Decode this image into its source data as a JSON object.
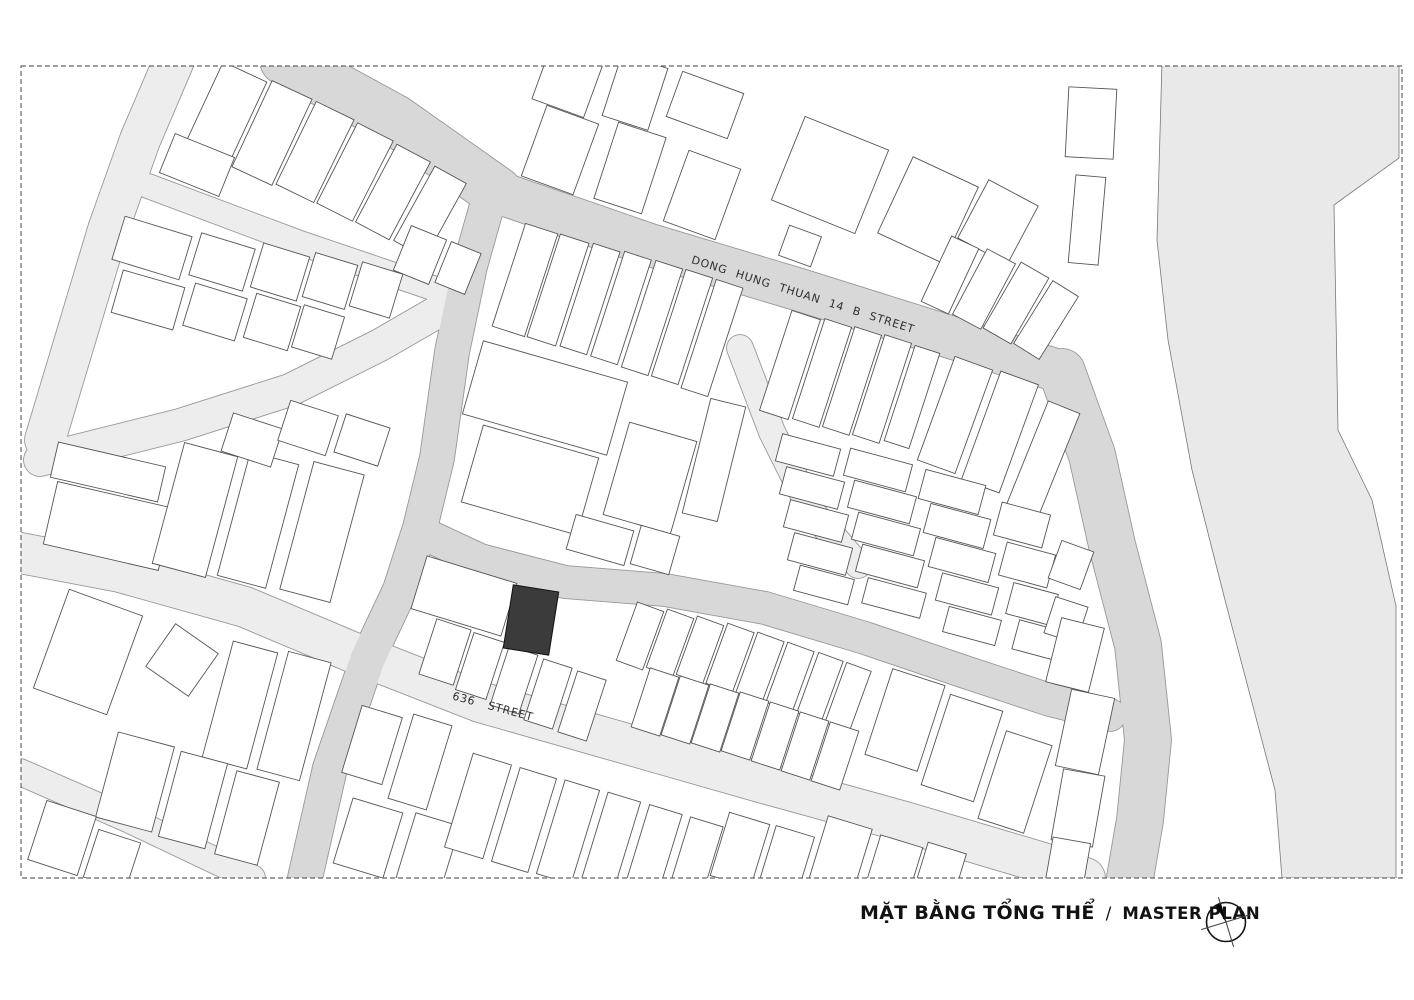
{
  "title": {
    "vi": "MẶT BẰNG TỔNG THỂ",
    "separator": "/",
    "en": "MASTER PLAN"
  },
  "colors": {
    "background": "#ffffff",
    "street_medium": "#d8d8d8",
    "street_light": "#ededed",
    "street_edge": "#989898",
    "river_fill": "#e9e9e9",
    "river_edge": "#787878",
    "building_fill": "#ffffff",
    "building_stroke": "#555555",
    "site_fill": "#3b3b3b",
    "site_stroke": "#111111",
    "border_stroke": "#666666",
    "label_ink": "#2e2e2e"
  },
  "map": {
    "border": {
      "x": 21,
      "y": 66,
      "w": 1381,
      "h": 812
    },
    "river": {
      "points": [
        [
          1162,
          62
        ],
        [
          1157,
          240
        ],
        [
          1168,
          340
        ],
        [
          1192,
          470
        ],
        [
          1225,
          600
        ],
        [
          1275,
          790
        ],
        [
          1282,
          878
        ],
        [
          1396,
          878
        ],
        [
          1396,
          606
        ],
        [
          1372,
          500
        ],
        [
          1338,
          430
        ],
        [
          1334,
          205
        ],
        [
          1399,
          158
        ],
        [
          1399,
          62
        ]
      ]
    },
    "streets": [
      {
        "id": "street-northwest-light",
        "tone": "light",
        "width": 40,
        "points": [
          [
            175,
            58
          ],
          [
            140,
            140
          ],
          [
            108,
            230
          ],
          [
            75,
            340
          ],
          [
            45,
            440
          ]
        ]
      },
      {
        "id": "lane-northwest-upper",
        "tone": "light",
        "width": 24,
        "points": [
          [
            148,
            186
          ],
          [
            300,
            243
          ],
          [
            462,
            298
          ]
        ]
      },
      {
        "id": "lane-northwest-lower",
        "tone": "light",
        "width": 32,
        "points": [
          [
            458,
            300
          ],
          [
            380,
            345
          ],
          [
            290,
            390
          ],
          [
            180,
            425
          ],
          [
            40,
            460
          ]
        ]
      },
      {
        "id": "street-636",
        "tone": "light",
        "width": 40,
        "points": [
          [
            15,
            552
          ],
          [
            120,
            572
          ],
          [
            245,
            607
          ],
          [
            352,
            652
          ],
          [
            480,
            702
          ],
          [
            620,
            742
          ],
          [
            760,
            782
          ],
          [
            905,
            822
          ],
          [
            1040,
            862
          ],
          [
            1085,
            878
          ]
        ]
      },
      {
        "id": "lane-southwest",
        "tone": "light",
        "width": 26,
        "points": [
          [
            20,
            772
          ],
          [
            130,
            820
          ],
          [
            252,
            878
          ]
        ]
      },
      {
        "id": "lane-central-east",
        "tone": "light",
        "width": 26,
        "points": [
          [
            740,
            348
          ],
          [
            772,
            432
          ],
          [
            812,
            512
          ],
          [
            858,
            565
          ]
        ]
      },
      {
        "id": "street-northwest-main",
        "tone": "medium",
        "width": 50,
        "points": [
          [
            285,
            60
          ],
          [
            395,
            120
          ],
          [
            497,
            192
          ]
        ]
      },
      {
        "id": "street-dong-hung-thuan-14b",
        "tone": "medium",
        "width": 42,
        "points": [
          [
            497,
            192
          ],
          [
            650,
            245
          ],
          [
            800,
            290
          ],
          [
            950,
            337
          ],
          [
            1062,
            372
          ]
        ]
      },
      {
        "id": "street-east-vertical",
        "tone": "medium",
        "width": 46,
        "points": [
          [
            1062,
            372
          ],
          [
            1092,
            455
          ],
          [
            1112,
            545
          ],
          [
            1138,
            645
          ],
          [
            1148,
            740
          ],
          [
            1140,
            820
          ],
          [
            1130,
            878
          ]
        ]
      },
      {
        "id": "street-central-vertical",
        "tone": "medium",
        "width": 34,
        "points": [
          [
            492,
            188
          ],
          [
            470,
            266
          ],
          [
            452,
            352
          ],
          [
            437,
            458
          ],
          [
            420,
            528
          ],
          [
            400,
            590
          ],
          [
            368,
            658
          ],
          [
            330,
            768
          ],
          [
            305,
            878
          ]
        ]
      },
      {
        "id": "street-middle-horizontal",
        "tone": "medium",
        "width": 32,
        "points": [
          [
            420,
            532
          ],
          [
            480,
            560
          ],
          [
            565,
            582
          ],
          [
            665,
            590
          ],
          [
            765,
            608
          ],
          [
            865,
            638
          ],
          [
            965,
            672
          ],
          [
            1050,
            700
          ],
          [
            1110,
            715
          ]
        ]
      }
    ],
    "labels": [
      {
        "id": "street-label-dong-hung-thuan-14b",
        "text": "DONG HUNG THUAN 14 B  STREET",
        "x": 802,
        "y": 298,
        "rotate": 17.5,
        "size": 11,
        "word_spacing": 5,
        "letter_spacing": 0.8
      },
      {
        "id": "street-label-636",
        "text": "636  STREET",
        "x": 492,
        "y": 710,
        "rotate": 15,
        "size": 11,
        "word_spacing": 9,
        "letter_spacing": 0.8
      }
    ],
    "site": {
      "cx": 531,
      "cy": 620,
      "w": 46,
      "h": 64,
      "rot": 9
    },
    "buildings": [
      [
        225,
        115,
        48,
        95,
        25
      ],
      [
        272,
        133,
        44,
        95,
        25
      ],
      [
        315,
        152,
        42,
        92,
        26
      ],
      [
        355,
        172,
        40,
        90,
        27
      ],
      [
        393,
        192,
        38,
        88,
        28
      ],
      [
        430,
        212,
        36,
        85,
        29
      ],
      [
        197,
        165,
        64,
        42,
        22
      ],
      [
        420,
        255,
        38,
        48,
        22
      ],
      [
        458,
        268,
        32,
        44,
        22
      ],
      [
        152,
        248,
        70,
        45,
        17
      ],
      [
        222,
        262,
        56,
        44,
        17
      ],
      [
        280,
        272,
        48,
        46,
        17
      ],
      [
        330,
        281,
        44,
        46,
        17
      ],
      [
        376,
        290,
        42,
        46,
        17
      ],
      [
        148,
        300,
        64,
        44,
        16
      ],
      [
        215,
        312,
        54,
        44,
        17
      ],
      [
        272,
        322,
        46,
        46,
        17
      ],
      [
        318,
        332,
        42,
        44,
        17
      ],
      [
        108,
        472,
        110,
        36,
        13
      ],
      [
        108,
        526,
        118,
        64,
        13
      ],
      [
        195,
        510,
        55,
        125,
        15
      ],
      [
        258,
        520,
        50,
        128,
        15
      ],
      [
        322,
        532,
        52,
        132,
        15
      ],
      [
        252,
        440,
        52,
        40,
        18
      ],
      [
        308,
        428,
        50,
        42,
        18
      ],
      [
        362,
        440,
        46,
        40,
        18
      ],
      [
        88,
        652,
        78,
        105,
        20
      ],
      [
        182,
        660,
        52,
        52,
        35
      ],
      [
        240,
        705,
        46,
        120,
        15
      ],
      [
        294,
        716,
        44,
        122,
        15
      ],
      [
        135,
        782,
        58,
        88,
        15
      ],
      [
        193,
        800,
        48,
        88,
        15
      ],
      [
        247,
        818,
        44,
        86,
        15
      ],
      [
        62,
        838,
        52,
        62,
        18
      ],
      [
        112,
        860,
        44,
        50,
        18
      ],
      [
        464,
        596,
        94,
        55,
        17
      ],
      [
        445,
        652,
        36,
        58,
        18
      ],
      [
        480,
        666,
        32,
        60,
        18
      ],
      [
        514,
        680,
        30,
        62,
        18
      ],
      [
        548,
        694,
        30,
        64,
        18
      ],
      [
        582,
        706,
        30,
        64,
        18
      ],
      [
        640,
        636,
        28,
        62,
        20
      ],
      [
        670,
        643,
        28,
        62,
        20
      ],
      [
        700,
        650,
        28,
        62,
        20
      ],
      [
        730,
        658,
        28,
        64,
        20
      ],
      [
        760,
        667,
        28,
        64,
        20
      ],
      [
        790,
        677,
        28,
        64,
        20
      ],
      [
        820,
        687,
        26,
        64,
        20
      ],
      [
        848,
        697,
        26,
        64,
        20
      ],
      [
        655,
        702,
        30,
        62,
        18
      ],
      [
        685,
        710,
        30,
        62,
        18
      ],
      [
        715,
        718,
        30,
        62,
        18
      ],
      [
        745,
        726,
        30,
        62,
        18
      ],
      [
        775,
        736,
        30,
        62,
        18
      ],
      [
        805,
        746,
        30,
        62,
        18
      ],
      [
        835,
        756,
        30,
        62,
        18
      ],
      [
        905,
        720,
        55,
        90,
        18
      ],
      [
        962,
        748,
        55,
        95,
        18
      ],
      [
        1015,
        782,
        48,
        92,
        18
      ],
      [
        525,
        280,
        34,
        108,
        18
      ],
      [
        558,
        290,
        30,
        108,
        18
      ],
      [
        590,
        299,
        28,
        108,
        18
      ],
      [
        621,
        308,
        28,
        110,
        18
      ],
      [
        652,
        318,
        28,
        112,
        18
      ],
      [
        682,
        327,
        28,
        112,
        18
      ],
      [
        712,
        338,
        28,
        114,
        18
      ],
      [
        545,
        398,
        150,
        76,
        16
      ],
      [
        530,
        480,
        120,
        80,
        16
      ],
      [
        650,
        478,
        70,
        96,
        16
      ],
      [
        714,
        460,
        36,
        118,
        14
      ],
      [
        600,
        540,
        60,
        36,
        16
      ],
      [
        655,
        550,
        40,
        40,
        16
      ],
      [
        790,
        365,
        30,
        105,
        18
      ],
      [
        822,
        373,
        28,
        105,
        18
      ],
      [
        852,
        381,
        28,
        105,
        18
      ],
      [
        882,
        389,
        28,
        105,
        18
      ],
      [
        912,
        397,
        26,
        100,
        18
      ],
      [
        955,
        415,
        40,
        110,
        20
      ],
      [
        1000,
        432,
        40,
        115,
        20
      ],
      [
        1042,
        462,
        34,
        118,
        22
      ],
      [
        808,
        455,
        60,
        28,
        15
      ],
      [
        812,
        488,
        60,
        28,
        15
      ],
      [
        816,
        521,
        60,
        28,
        15
      ],
      [
        820,
        554,
        60,
        28,
        15
      ],
      [
        824,
        585,
        56,
        26,
        15
      ],
      [
        878,
        470,
        64,
        28,
        15
      ],
      [
        882,
        502,
        64,
        28,
        15
      ],
      [
        886,
        534,
        64,
        28,
        15
      ],
      [
        890,
        566,
        64,
        28,
        15
      ],
      [
        894,
        598,
        60,
        26,
        15
      ],
      [
        952,
        492,
        62,
        30,
        15
      ],
      [
        957,
        526,
        62,
        30,
        15
      ],
      [
        962,
        560,
        62,
        30,
        15
      ],
      [
        967,
        594,
        58,
        28,
        15
      ],
      [
        972,
        626,
        54,
        26,
        15
      ],
      [
        1022,
        525,
        50,
        34,
        15
      ],
      [
        1027,
        565,
        50,
        34,
        15
      ],
      [
        1032,
        604,
        46,
        32,
        15
      ],
      [
        1037,
        640,
        44,
        30,
        15
      ],
      [
        1071,
        565,
        34,
        40,
        20
      ],
      [
        1066,
        620,
        34,
        38,
        18
      ],
      [
        568,
        80,
        55,
        60,
        20
      ],
      [
        560,
        150,
        55,
        75,
        20
      ],
      [
        635,
        92,
        48,
        65,
        18
      ],
      [
        630,
        168,
        50,
        80,
        18
      ],
      [
        705,
        105,
        65,
        48,
        20
      ],
      [
        702,
        195,
        55,
        75,
        20
      ],
      [
        830,
        175,
        90,
        90,
        22
      ],
      [
        928,
        210,
        72,
        84,
        25
      ],
      [
        998,
        222,
        56,
        66,
        28
      ],
      [
        950,
        275,
        30,
        72,
        25
      ],
      [
        984,
        289,
        32,
        74,
        28
      ],
      [
        1016,
        303,
        32,
        76,
        30
      ],
      [
        1046,
        320,
        30,
        74,
        32
      ],
      [
        800,
        246,
        34,
        32,
        20
      ],
      [
        1091,
        123,
        48,
        70,
        3
      ],
      [
        1087,
        220,
        30,
        88,
        5
      ],
      [
        372,
        745,
        42,
        70,
        17
      ],
      [
        420,
        762,
        40,
        88,
        17
      ],
      [
        368,
        838,
        52,
        68,
        17
      ],
      [
        428,
        852,
        46,
        68,
        17
      ],
      [
        478,
        806,
        40,
        98,
        17
      ],
      [
        524,
        820,
        38,
        98,
        17
      ],
      [
        568,
        832,
        36,
        98,
        17
      ],
      [
        610,
        844,
        34,
        98,
        17
      ],
      [
        652,
        855,
        34,
        95,
        17
      ],
      [
        694,
        864,
        34,
        88,
        17
      ],
      [
        740,
        850,
        42,
        66,
        17
      ],
      [
        786,
        862,
        40,
        64,
        17
      ],
      [
        840,
        856,
        46,
        70,
        17
      ],
      [
        893,
        870,
        44,
        60,
        17
      ],
      [
        940,
        872,
        40,
        50,
        17
      ],
      [
        1075,
        655,
        44,
        66,
        14
      ],
      [
        1085,
        732,
        44,
        78,
        12
      ],
      [
        1078,
        808,
        42,
        72,
        10
      ],
      [
        1068,
        862,
        38,
        44,
        10
      ]
    ]
  }
}
